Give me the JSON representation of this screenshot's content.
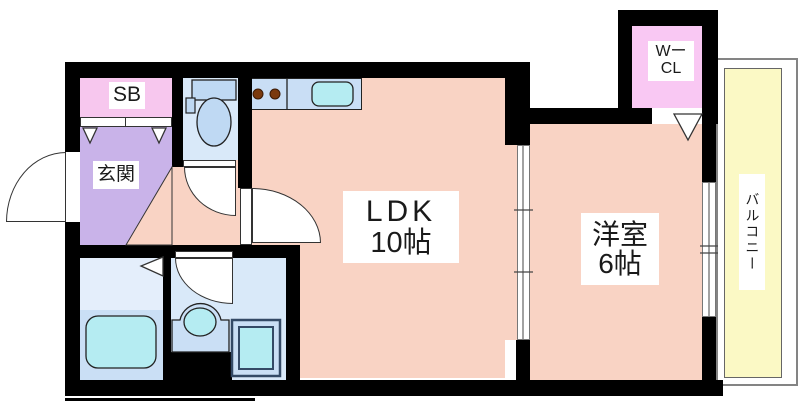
{
  "document": {
    "kind": "apartment-floor-plan"
  },
  "labels": {
    "ldk_line1": "LDK",
    "ldk_line2": "10帖",
    "western_room_line1": "洋室",
    "western_room_line2": "6帖",
    "entrance": "玄関",
    "shoe_box": "SB",
    "walk_in_closet_line1": "Wー",
    "walk_in_closet_line2": "CL",
    "balcony": "バルコニー"
  },
  "colors": {
    "wall": "#000000",
    "line": "#333333",
    "floor_main": "#f9d3c4",
    "genkan": "#c9b3e9",
    "sb": "#f7c7ee",
    "wcl": "#f9c8f3",
    "water_room": "#d9e9f9",
    "water_room_light": "#e4eefb",
    "water_room_dark": "#cadff5",
    "counter": "#c9def5",
    "fixture_fill": "#bfd9f3",
    "cyan": "#b5ecf2",
    "balcony": "#fbf9c5",
    "balcony_frame_border": "#848484",
    "burner": "#7b3a0e",
    "label_bg": "#ffffff"
  }
}
